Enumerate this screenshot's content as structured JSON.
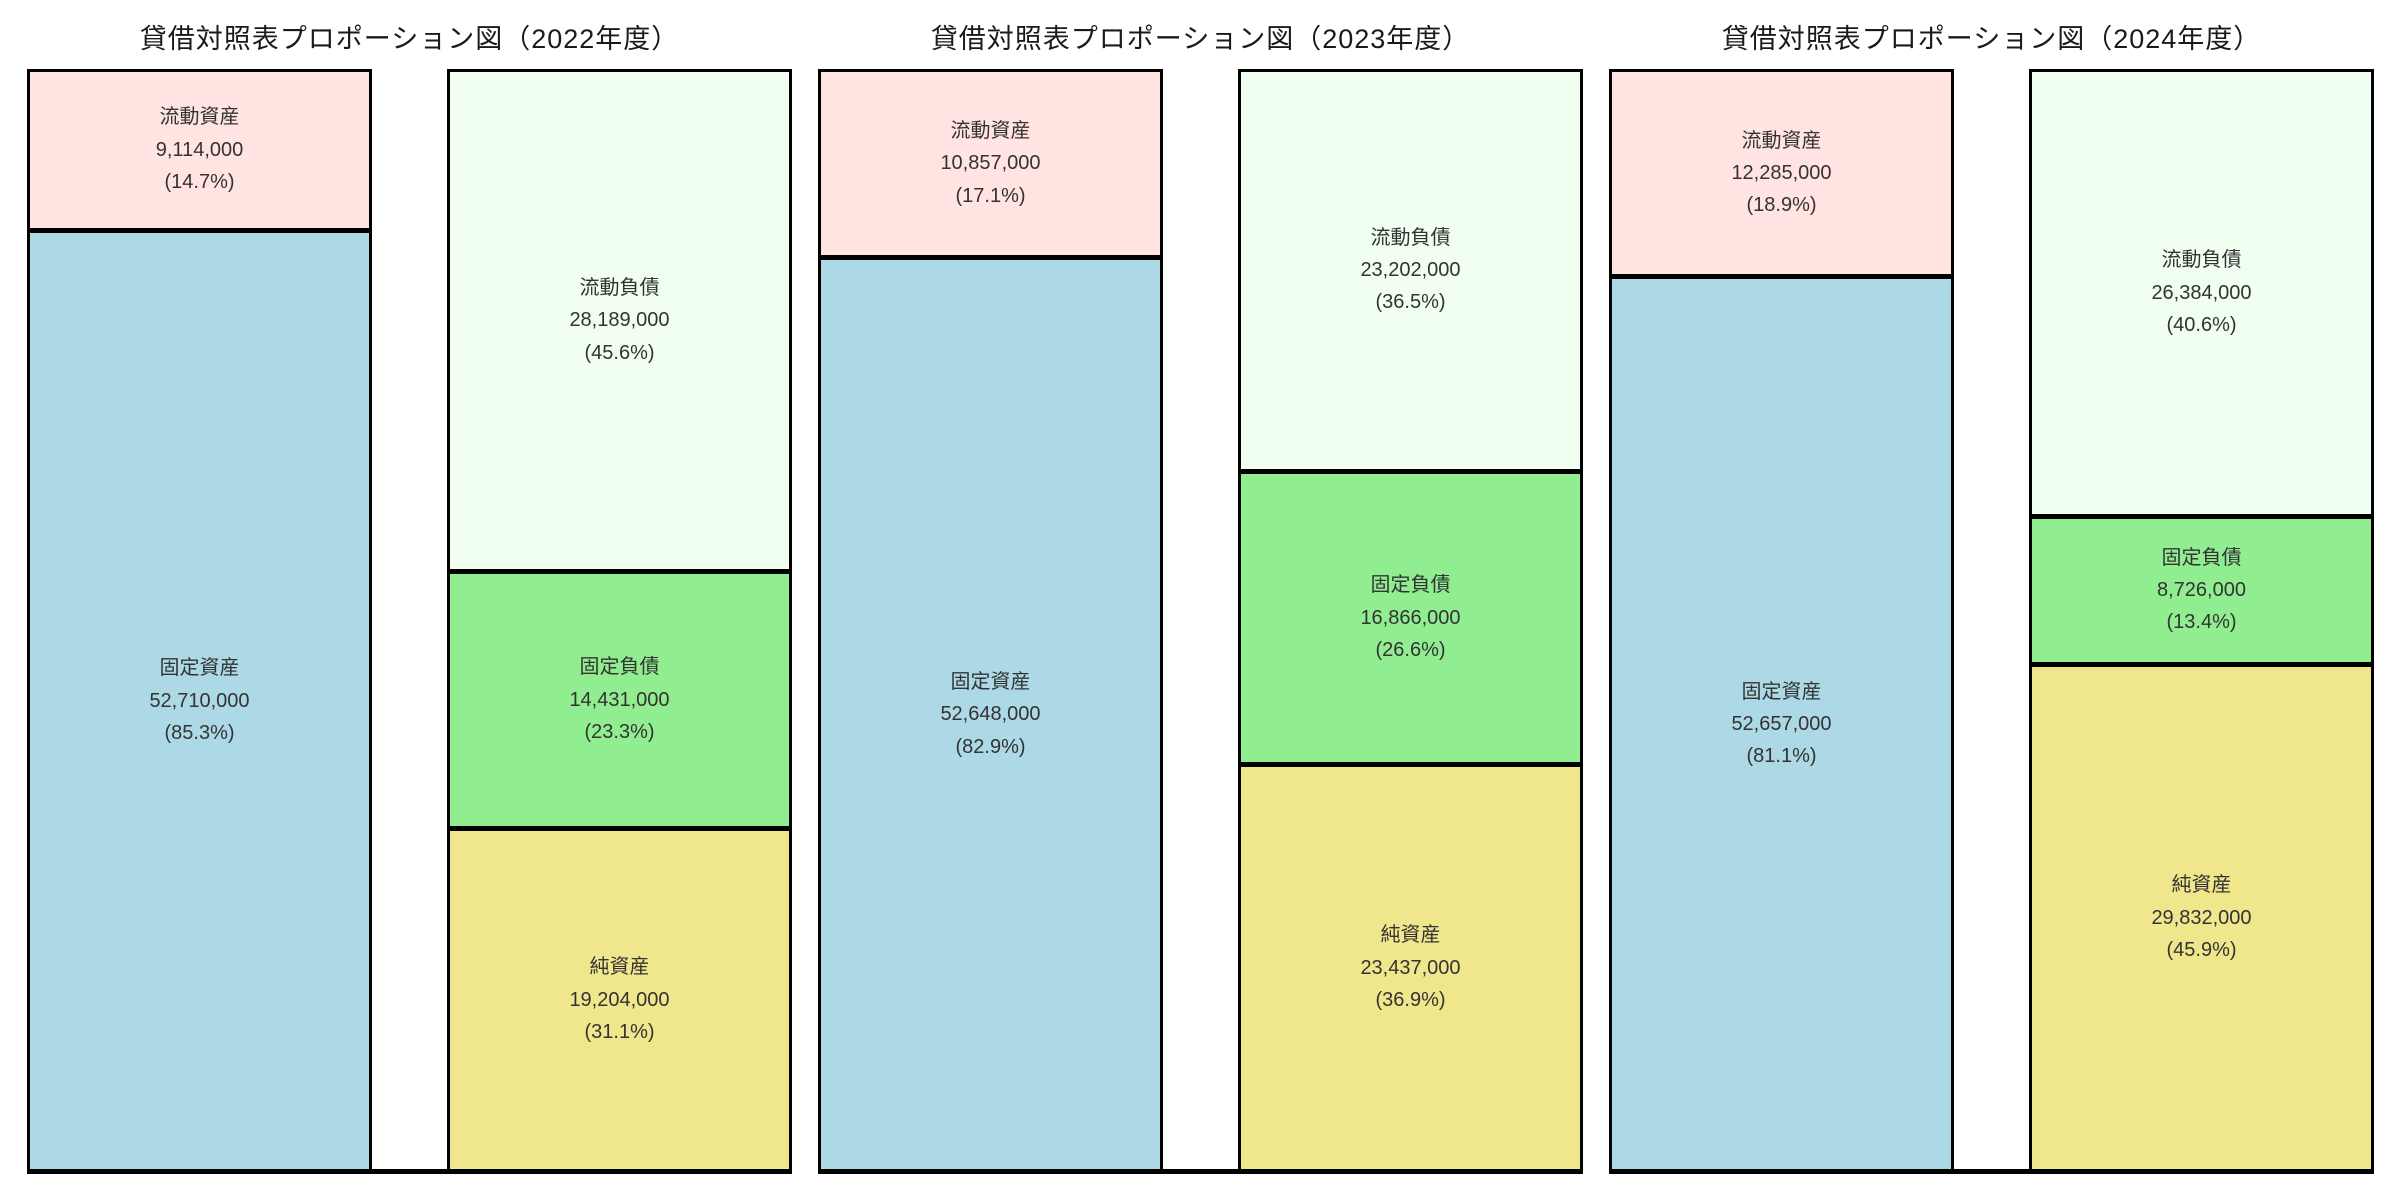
{
  "figure": {
    "background": "#ffffff",
    "border_color": "#000000",
    "text_color": "#333333"
  },
  "chart_data": [
    {
      "type": "bar",
      "subtype": "proportional-stacked-columns",
      "title": "貸借対照表プロポーション図（2022年度）",
      "legend": "none",
      "grid": false,
      "columns": [
        {
          "side": "left",
          "segments": [
            {
              "key": "current-assets",
              "label": "流動資産",
              "value": 9114000,
              "display_value": "9,114,000",
              "percent": 14.7,
              "display_percent": "(14.7%)",
              "color": "#ffe4e1"
            },
            {
              "key": "fixed-assets",
              "label": "固定資産",
              "value": 52710000,
              "display_value": "52,710,000",
              "percent": 85.3,
              "display_percent": "(85.3%)",
              "color": "#add8e6"
            }
          ]
        },
        {
          "side": "right",
          "segments": [
            {
              "key": "current-liabilities",
              "label": "流動負債",
              "value": 28189000,
              "display_value": "28,189,000",
              "percent": 45.6,
              "display_percent": "(45.6%)",
              "color": "#f0fff0"
            },
            {
              "key": "fixed-liabilities",
              "label": "固定負債",
              "value": 14431000,
              "display_value": "14,431,000",
              "percent": 23.3,
              "display_percent": "(23.3%)",
              "color": "#90ee90"
            },
            {
              "key": "net-assets",
              "label": "純資産",
              "value": 19204000,
              "display_value": "19,204,000",
              "percent": 31.1,
              "display_percent": "(31.1%)",
              "color": "#f0e68c"
            }
          ]
        }
      ]
    },
    {
      "type": "bar",
      "subtype": "proportional-stacked-columns",
      "title": "貸借対照表プロポーション図（2023年度）",
      "legend": "none",
      "grid": false,
      "columns": [
        {
          "side": "left",
          "segments": [
            {
              "key": "current-assets",
              "label": "流動資産",
              "value": 10857000,
              "display_value": "10,857,000",
              "percent": 17.1,
              "display_percent": "(17.1%)",
              "color": "#ffe4e1"
            },
            {
              "key": "fixed-assets",
              "label": "固定資産",
              "value": 52648000,
              "display_value": "52,648,000",
              "percent": 82.9,
              "display_percent": "(82.9%)",
              "color": "#add8e6"
            }
          ]
        },
        {
          "side": "right",
          "segments": [
            {
              "key": "current-liabilities",
              "label": "流動負債",
              "value": 23202000,
              "display_value": "23,202,000",
              "percent": 36.5,
              "display_percent": "(36.5%)",
              "color": "#f0fff0"
            },
            {
              "key": "fixed-liabilities",
              "label": "固定負債",
              "value": 16866000,
              "display_value": "16,866,000",
              "percent": 26.6,
              "display_percent": "(26.6%)",
              "color": "#90ee90"
            },
            {
              "key": "net-assets",
              "label": "純資産",
              "value": 23437000,
              "display_value": "23,437,000",
              "percent": 36.9,
              "display_percent": "(36.9%)",
              "color": "#f0e68c"
            }
          ]
        }
      ]
    },
    {
      "type": "bar",
      "subtype": "proportional-stacked-columns",
      "title": "貸借対照表プロポーション図（2024年度）",
      "legend": "none",
      "grid": false,
      "columns": [
        {
          "side": "left",
          "segments": [
            {
              "key": "current-assets",
              "label": "流動資産",
              "value": 12285000,
              "display_value": "12,285,000",
              "percent": 18.9,
              "display_percent": "(18.9%)",
              "color": "#ffe4e1"
            },
            {
              "key": "fixed-assets",
              "label": "固定資産",
              "value": 52657000,
              "display_value": "52,657,000",
              "percent": 81.1,
              "display_percent": "(81.1%)",
              "color": "#add8e6"
            }
          ]
        },
        {
          "side": "right",
          "segments": [
            {
              "key": "current-liabilities",
              "label": "流動負債",
              "value": 26384000,
              "display_value": "26,384,000",
              "percent": 40.6,
              "display_percent": "(40.6%)",
              "color": "#f0fff0"
            },
            {
              "key": "fixed-liabilities",
              "label": "固定負債",
              "value": 8726000,
              "display_value": "8,726,000",
              "percent": 13.4,
              "display_percent": "(13.4%)",
              "color": "#90ee90"
            },
            {
              "key": "net-assets",
              "label": "純資産",
              "value": 29832000,
              "display_value": "29,832,000",
              "percent": 45.9,
              "display_percent": "(45.9%)",
              "color": "#f0e68c"
            }
          ]
        }
      ]
    }
  ]
}
